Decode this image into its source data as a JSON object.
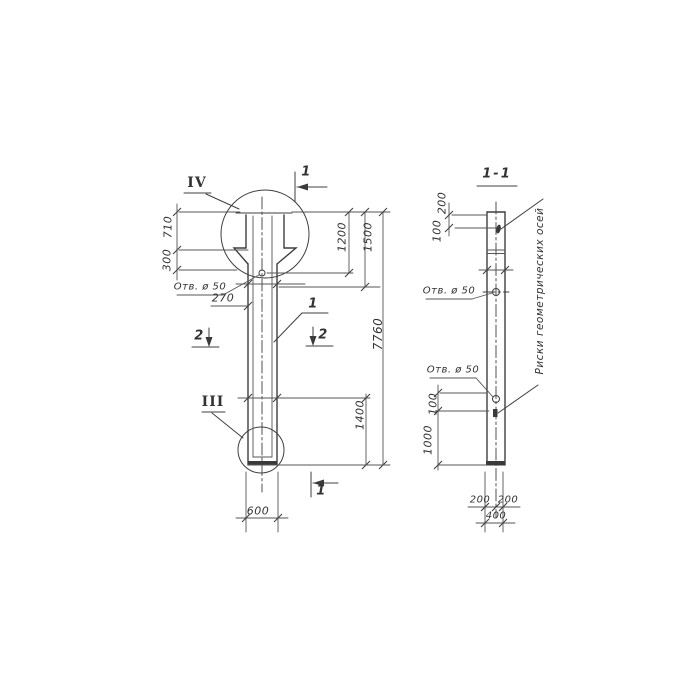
{
  "front_view": {
    "detail_label_top": "IV",
    "detail_label_bottom": "III",
    "section_cut_top": "1",
    "section_cut_bottom": "1",
    "section_cut_left": "2",
    "section_cut_right": "2",
    "part_label": "1",
    "dim_710": "710",
    "dim_300": "300",
    "hole_label": "Отв. ø 50",
    "dim_270": "270",
    "dim_1200": "1200",
    "dim_1500": "1500",
    "dim_7760": "7760",
    "dim_1400": "1400",
    "dim_600": "600"
  },
  "section_view": {
    "title": "1-1",
    "dim_200_top": "200",
    "dim_100_top": "100",
    "hole_label_upper": "Отв. ø 50",
    "hole_label_lower": "Отв. ø 50",
    "dim_100_left": "100",
    "dim_1000_left": "1000",
    "dim_200_bottom_left": "200",
    "dim_200_bottom_right": "200",
    "dim_400_bottom": "400",
    "axes_note": "Риски геометрических осей"
  },
  "colors": {
    "ink": "#3a3a3a",
    "paper": "#ffffff"
  }
}
